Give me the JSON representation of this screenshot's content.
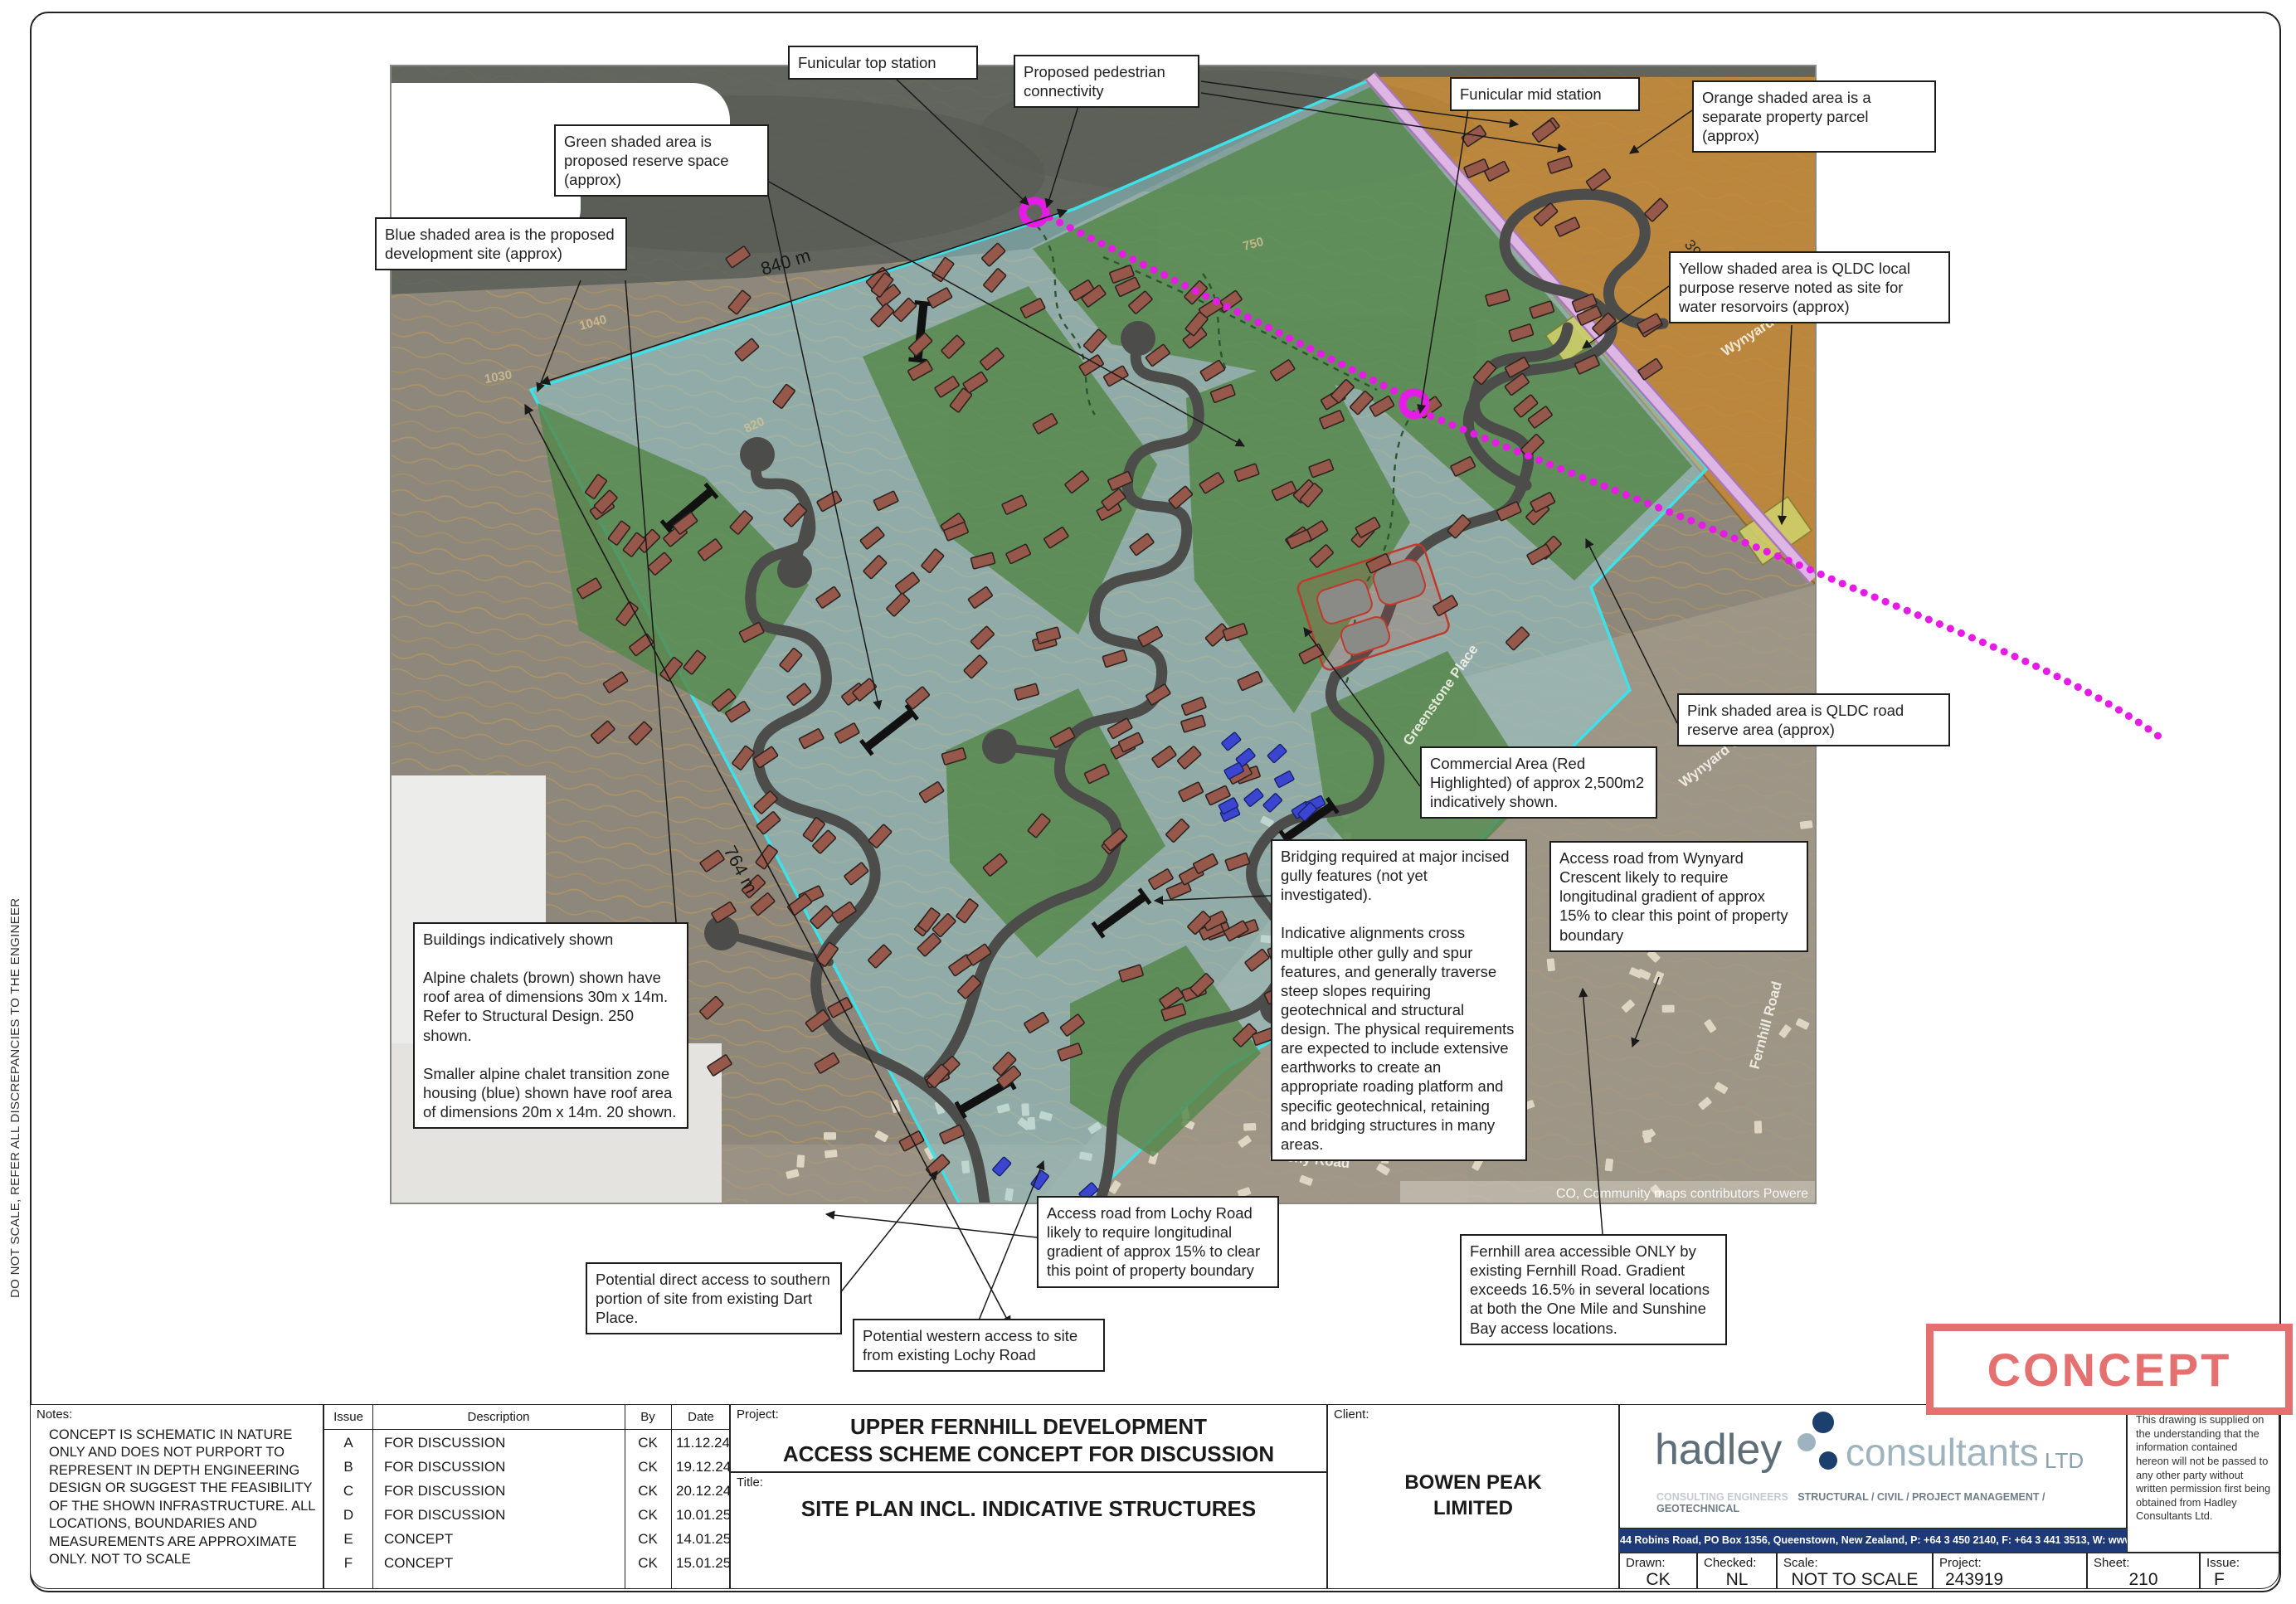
{
  "sheet": {
    "vertical_note": "DO NOT SCALE, REFER ALL DISCREPANCIES TO THE ENGINEER"
  },
  "map": {
    "labels": {
      "dim_840": "840 m",
      "dim_764": "764 m",
      "dim_396": "396 m"
    },
    "streets": [
      "Greenstone Place",
      "Wynyard Crescent",
      "Lochy Road",
      "Fernhill Road",
      "Wynyard Crescent"
    ],
    "contour_labels": [
      "1040",
      "1030",
      "820",
      "750"
    ],
    "attribution": "CO, Community maps contributors   Powere",
    "chalet_count": 250,
    "transition_count": 20,
    "colors": {
      "chalet": "#96584a",
      "chalet_stroke": "#2f2420",
      "transition": "#3a46cf",
      "transition_stroke": "#1a2070",
      "house": "#ded5c2",
      "site_boundary": "#3ee1e8",
      "reserve_green": "#55874a",
      "parcel_orange": "#c8872e",
      "road_reserve_pink": "#ddb6e4",
      "water_reserve_yellow": "#cfd06a",
      "pedestrian_magenta": "#e51ce5"
    }
  },
  "callouts": {
    "funicular_top": {
      "text": "Funicular top station"
    },
    "pedestrian": {
      "text": "Proposed pedestrian connectivity"
    },
    "green_area": {
      "text": "Green shaded area is proposed reserve space (approx)"
    },
    "blue_area": {
      "text": "Blue shaded area is the proposed development site (approx)"
    },
    "funicular_mid": {
      "text": "Funicular mid station"
    },
    "orange_area": {
      "text": "Orange shaded area is a separate property parcel (approx)"
    },
    "yellow_area": {
      "text": "Yellow shaded area is QLDC local purpose reserve noted as site for water resorvoirs (approx)"
    },
    "pink_area": {
      "text": "Pink shaded area is QLDC road reserve area (approx)"
    },
    "commercial": {
      "text": "Commercial Area (Red Highlighted) of approx 2,500m2 indicatively shown."
    },
    "wynyard_access": {
      "text": "Access road from Wynyard Crescent likely to require longitudinal gradient of approx 15% to clear this point of property boundary"
    },
    "bridging": {
      "p1": "Bridging required at major incised gully features (not yet investigated).",
      "p2": "Indicative alignments cross multiple other gully and spur features, and generally traverse steep slopes requiring geotechnical and structural design. The physical requirements are expected to include extensive earthworks to create an appropriate roading platform and specific geotechnical, retaining and bridging structures in many areas."
    },
    "buildings": {
      "p1": "Buildings indicatively shown",
      "p2": "Alpine chalets (brown) shown have roof area of dimensions 30m x 14m. Refer to Structural Design. 250 shown.",
      "p3": "Smaller alpine chalet transition zone housing (blue) shown have roof area of dimensions 20m x 14m. 20 shown."
    },
    "lochy_access": {
      "text": "Access road from Lochy Road likely to require longitudinal gradient of approx 15% to clear this point of property boundary"
    },
    "dart_access": {
      "text": "Potential direct access to southern portion of site from existing Dart Place."
    },
    "western_access": {
      "text": "Potential western access to site from existing Lochy Road"
    },
    "fernhill": {
      "text": "Fernhill area accessible ONLY by existing Fernhill Road. Gradient exceeds 16.5% in several locations at both the One Mile and Sunshine Bay access locations."
    }
  },
  "title_block": {
    "notes_label": "Notes:",
    "notes_text": "CONCEPT IS SCHEMATIC IN NATURE ONLY AND DOES NOT PURPORT TO REPRESENT IN DEPTH ENGINEERING DESIGN OR SUGGEST THE FEASIBILITY OF THE SHOWN INFRASTRUCTURE. ALL LOCATIONS, BOUNDARIES AND MEASUREMENTS ARE APPROXIMATE ONLY. NOT TO SCALE",
    "revision": {
      "headers": [
        "Issue",
        "Description",
        "By",
        "Date"
      ],
      "rows": [
        {
          "issue": "A",
          "description": "FOR DISCUSSION",
          "by": "CK",
          "date": "11.12.24"
        },
        {
          "issue": "B",
          "description": "FOR DISCUSSION",
          "by": "CK",
          "date": "19.12.24"
        },
        {
          "issue": "C",
          "description": "FOR DISCUSSION",
          "by": "CK",
          "date": "20.12.24"
        },
        {
          "issue": "D",
          "description": "FOR DISCUSSION",
          "by": "CK",
          "date": "10.01.25"
        },
        {
          "issue": "E",
          "description": "CONCEPT",
          "by": "CK",
          "date": "14.01.25"
        },
        {
          "issue": "F",
          "description": "CONCEPT",
          "by": "CK",
          "date": "15.01.25"
        }
      ]
    },
    "project_label": "Project:",
    "project_line1": "UPPER FERNHILL DEVELOPMENT",
    "project_line2": "ACCESS SCHEME CONCEPT FOR DISCUSSION",
    "title_label": "Title:",
    "title_name": "SITE PLAN INCL. INDICATIVE STRUCTURES",
    "client_label": "Client:",
    "client_line1": "BOWEN PEAK",
    "client_line2": "LIMITED",
    "hadley": {
      "name1": "hadley",
      "name2": "consultants",
      "name3": "LTD",
      "tagline1": "CONSULTING ENGINEERS",
      "tagline2": "STRUCTURAL / CIVIL / PROJECT MANAGEMENT / GEOTECHNICAL",
      "address": "44 Robins Road, PO Box 1356, Queenstown, New Zealand, P: +64 3 450 2140, F: +64 3 441 3513, W: www.hadleys.co.nz"
    },
    "disclaimer": "This drawing is supplied on the understanding that the information contained hereon will not be passed to any other party without written permission first being obtained from Hadley Consultants Ltd.",
    "fields": {
      "drawn_label": "Drawn:",
      "drawn": "CK",
      "checked_label": "Checked:",
      "checked": "NL",
      "scale_label": "Scale:",
      "scale": "NOT TO SCALE",
      "project_label": "Project:",
      "project": "243919",
      "sheet_label": "Sheet:",
      "sheet": "210",
      "issue_label": "Issue:",
      "issue": "F"
    }
  },
  "stamp": {
    "text": "CONCEPT"
  }
}
